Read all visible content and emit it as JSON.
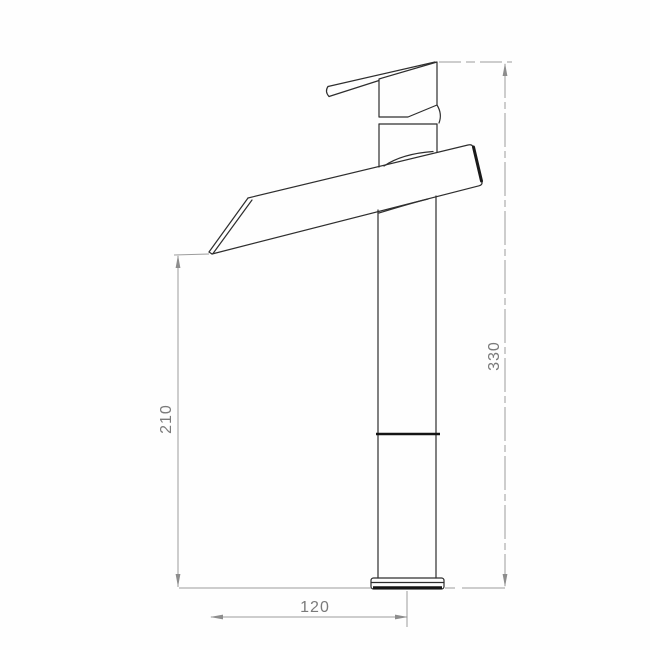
{
  "drawing": {
    "subject": "waterfall-basin-faucet",
    "view": "side-elevation-technical-drawing",
    "dimensions": {
      "overall_height": {
        "label": "330"
      },
      "spout_tip_height": {
        "label": "210"
      },
      "spout_reach": {
        "label": "120"
      }
    },
    "colors": {
      "outline": "#2e2e2e",
      "emphasis": "#141414",
      "dimension_line": "#9c9c9c",
      "dimension_text": "#7a7a7a",
      "background": "#ffffff"
    }
  }
}
